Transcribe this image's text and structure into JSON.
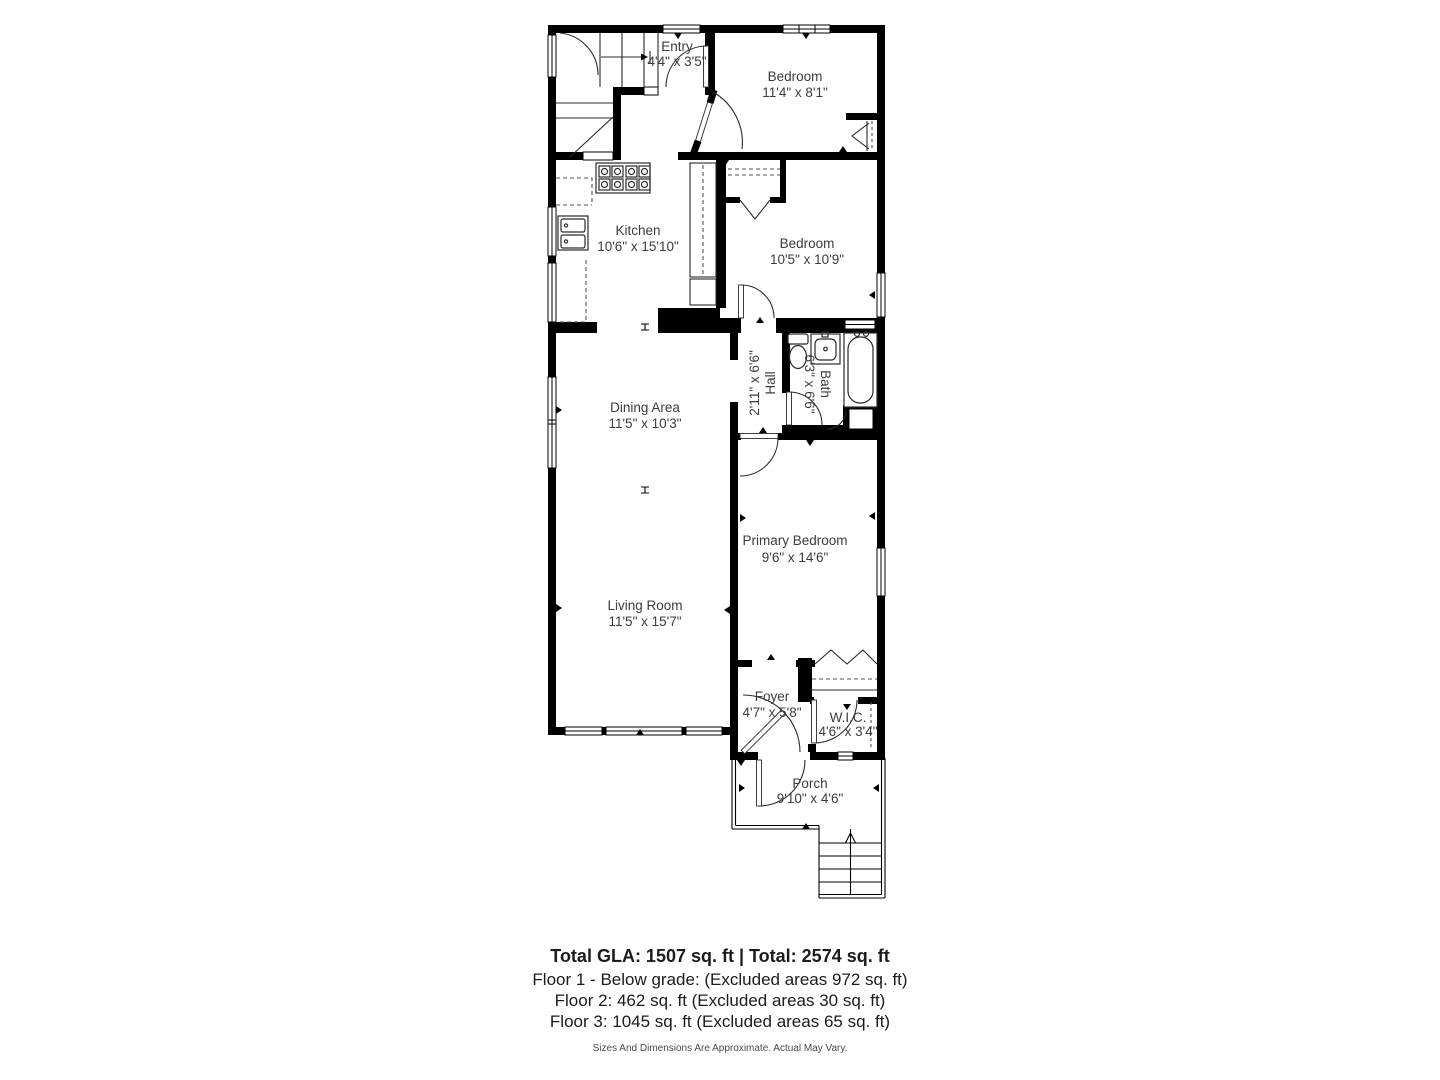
{
  "floorplan": {
    "rooms": [
      {
        "name": "Entry",
        "dims": "4'4\" x 3'5\""
      },
      {
        "name": "Bedroom",
        "dims": "11'4\" x 8'1\""
      },
      {
        "name": "Kitchen",
        "dims": "10'6\" x 15'10\""
      },
      {
        "name": "Bedroom",
        "dims": "10'5\" x 10'9\""
      },
      {
        "name": "Hall",
        "dims": "2'11\" x 6'6\""
      },
      {
        "name": "Bath",
        "dims": "6'3\" x 6'6\""
      },
      {
        "name": "Dining Area",
        "dims": "11'5\" x 10'3\""
      },
      {
        "name": "Primary Bedroom",
        "dims": "9'6\" x 14'6\""
      },
      {
        "name": "Living Room",
        "dims": "11'5\" x 15'7\""
      },
      {
        "name": "Foyer",
        "dims": "4'7\" x 5'8\""
      },
      {
        "name": "W.I.C.",
        "dims": "4'6\" x 3'4\""
      },
      {
        "name": "Porch",
        "dims": "9'10\" x 4'6\""
      }
    ],
    "colors": {
      "wall": "#000000",
      "label": "#3c3c3c",
      "line": "#222222"
    }
  },
  "summary": {
    "total_line": "Total GLA: 1507 sq. ft | Total: 2574 sq. ft",
    "floor1_line": "Floor 1 - Below grade: (Excluded areas 972 sq. ft)",
    "floor2_line": "Floor 2: 462 sq. ft (Excluded areas 30 sq. ft)",
    "floor3_line": "Floor 3: 1045 sq. ft (Excluded areas 65 sq. ft)",
    "disclaimer": "Sizes And Dimensions Are Approximate. Actual May Vary."
  }
}
